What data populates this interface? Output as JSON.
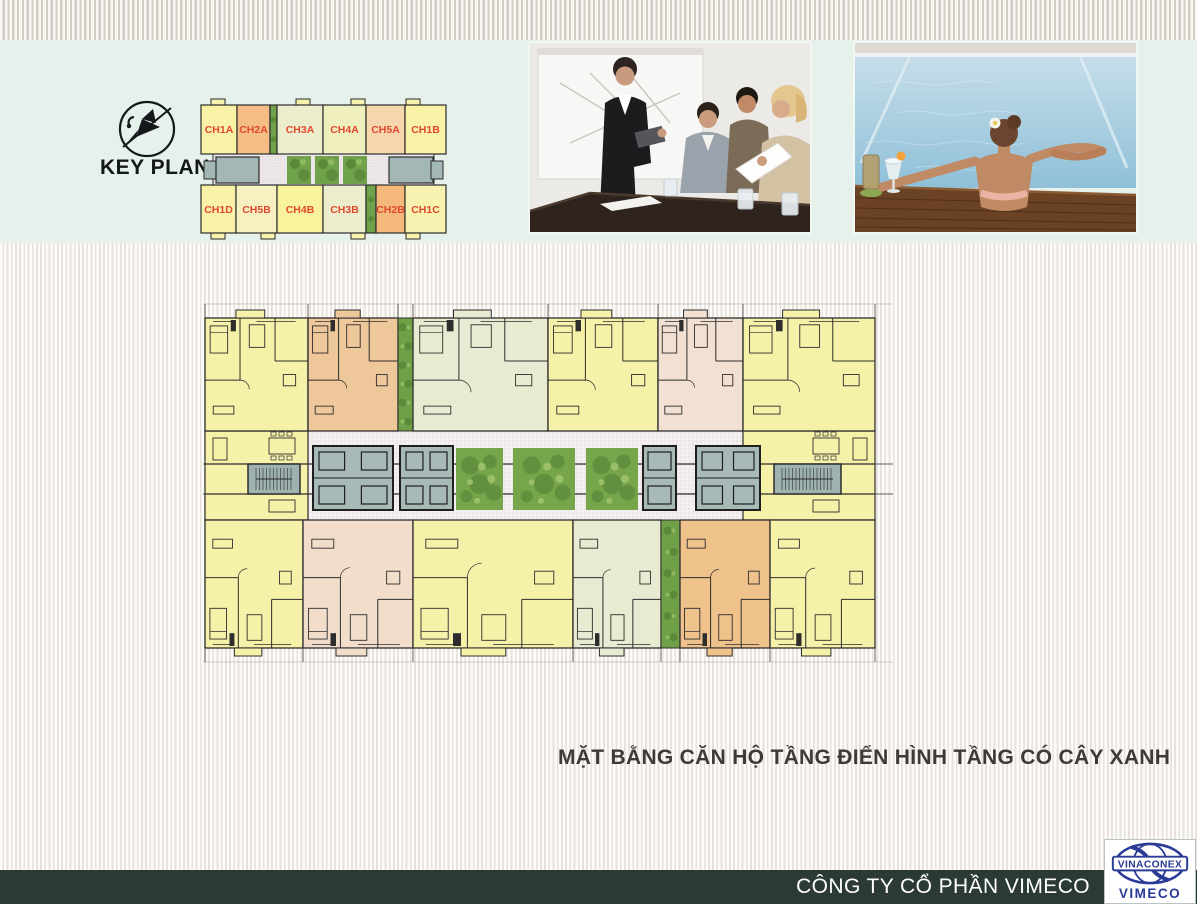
{
  "header": {
    "key_plan_title": "KEY PLAN"
  },
  "icons": {
    "keyplan": "bird-compass-icon",
    "logo": "vinaconex-globe-icon"
  },
  "photos": [
    {
      "name": "business-meeting-photo"
    },
    {
      "name": "poolside-relaxation-photo"
    }
  ],
  "key_plan": {
    "label_color": "#e0492e",
    "top_row": [
      {
        "label": "CH1A",
        "color": "#f9f2a6",
        "w": 36
      },
      {
        "label": "CH2A",
        "color": "#f3bd85",
        "w": 33
      },
      {
        "label": "",
        "color": "#6fa24a",
        "w": 7
      },
      {
        "label": "CH3A",
        "color": "#ecedcd",
        "w": 46
      },
      {
        "label": "CH4A",
        "color": "#eff0bd",
        "w": 43
      },
      {
        "label": "CH5A",
        "color": "#f6d7ad",
        "w": 39
      },
      {
        "label": "CH1B",
        "color": "#f9f2a6",
        "w": 41
      }
    ],
    "bottom_row": [
      {
        "label": "CH1D",
        "color": "#f9f2a6",
        "w": 35
      },
      {
        "label": "CH5B",
        "color": "#f7f0c0",
        "w": 41
      },
      {
        "label": "CH4B",
        "color": "#f9f39e",
        "w": 46
      },
      {
        "label": "CH3B",
        "color": "#ecedcd",
        "w": 43
      },
      {
        "label": "",
        "color": "#6fa24a",
        "w": 10
      },
      {
        "label": "CH2B",
        "color": "#f3b87a",
        "w": 29
      },
      {
        "label": "CH1C",
        "color": "#f7f2b0",
        "w": 41
      }
    ]
  },
  "floor_plan": {
    "wall_color": "#2d2d2d",
    "green_strip_color": "#6fa048",
    "corridor": {
      "floor": "#f5f2f3",
      "grid": "#e5cccc",
      "core_fill": "#a7bab8",
      "stair_fill": "#9eb3b1",
      "garden_color": "#76a54c",
      "gardens": 3
    },
    "top_row": [
      {
        "id": "CH1A",
        "color": "#f6f1a9",
        "w": 103
      },
      {
        "id": "CH2A",
        "color": "#eec79b",
        "w": 90
      },
      {
        "id": "strip",
        "color": "#6fa048",
        "w": 15
      },
      {
        "id": "CH3A",
        "color": "#e8ebd1",
        "w": 135
      },
      {
        "id": "CH4A",
        "color": "#f6f1a9",
        "w": 110
      },
      {
        "id": "CH5A",
        "color": "#f2e1d2",
        "w": 85
      },
      {
        "id": "CH1B",
        "color": "#f6f1a9",
        "w": 132
      }
    ],
    "bottom_row": [
      {
        "id": "CH1D",
        "color": "#f6f1a9",
        "w": 98
      },
      {
        "id": "CH5B",
        "color": "#f2ddca",
        "w": 110
      },
      {
        "id": "CH4B",
        "color": "#f6f1a9",
        "w": 160
      },
      {
        "id": "CH3B",
        "color": "#e8ebd1",
        "w": 88
      },
      {
        "id": "strip",
        "color": "#6fa048",
        "w": 19
      },
      {
        "id": "CH2B",
        "color": "#efc18b",
        "w": 90
      },
      {
        "id": "CH1C",
        "color": "#f6f1a9",
        "w": 105
      }
    ]
  },
  "caption": "MẶT BẰNG CĂN HỘ TẦNG ĐIỂN HÌNH TẦNG CÓ CÂY XANH",
  "footer": {
    "company_name": "CÔNG TY CỔ PHẦN VIMECO",
    "logo_primary": "VINACONEX",
    "logo_secondary": "VIMECO"
  },
  "colors": {
    "band_mint": "#e7f1ec",
    "footer_bar": "#2c3a35",
    "logo_blue": "#2a3a96",
    "caption_text": "#3e3a35"
  }
}
